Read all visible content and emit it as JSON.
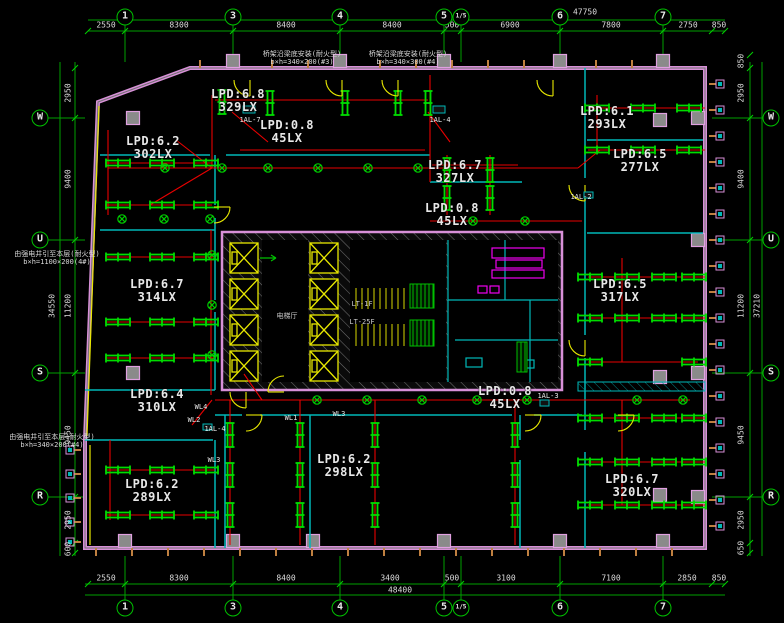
{
  "drawing_type": "electrical lighting floor plan",
  "grid": {
    "top_bubbles": [
      "1",
      "3",
      "4",
      "5",
      "1/5",
      "6",
      "7"
    ],
    "bottom_bubbles": [
      "1",
      "3",
      "4",
      "5",
      "1/5",
      "6",
      "7"
    ],
    "left_bubbles": [
      "W",
      "U",
      "S",
      "R"
    ],
    "right_bubbles": [
      "W",
      "U",
      "S",
      "R"
    ],
    "top_dims": [
      "2550",
      "8300",
      "8400",
      "8400",
      "500",
      "6900",
      "7800",
      "2750",
      "850"
    ],
    "top_overall": "47750",
    "bottom_dims": [
      "2550",
      "8300",
      "8400",
      "3400",
      "500",
      "3100",
      "7100",
      "2850",
      "850"
    ],
    "bottom_overall": "48400",
    "left_dims": [
      "2950",
      "9400",
      "11200",
      "9450",
      "2950",
      "600"
    ],
    "left_overall": "34550",
    "right_dims": [
      "850",
      "2950",
      "9400",
      "11200",
      "9450",
      "2950",
      "650"
    ],
    "right_overall": "37210"
  },
  "rooms": [
    {
      "lpd": "LPD:6.8",
      "lux": "329LX"
    },
    {
      "lpd": "LPD:0.8",
      "lux": "45LX"
    },
    {
      "lpd": "LPD:6.2",
      "lux": "302LX"
    },
    {
      "lpd": "LPD:6.7",
      "lux": "327LX"
    },
    {
      "lpd": "LPD:0.8",
      "lux": "45LX"
    },
    {
      "lpd": "LPD:6.1",
      "lux": "293LX"
    },
    {
      "lpd": "LPD:6.5",
      "lux": "277LX"
    },
    {
      "lpd": "LPD:6.5",
      "lux": "317LX"
    },
    {
      "lpd": "LPD:6.7",
      "lux": "314LX"
    },
    {
      "lpd": "LPD:6.4",
      "lux": "310LX"
    },
    {
      "lpd": "LPD:0.8",
      "lux": "45LX"
    },
    {
      "lpd": "LPD:6.2",
      "lux": "298LX"
    },
    {
      "lpd": "LPD:6.2",
      "lux": "289LX"
    },
    {
      "lpd": "LPD:6.7",
      "lux": "320LX"
    }
  ],
  "circuits": [
    "1AL-7",
    "1AL-4",
    "WL4",
    "WL2",
    "1AL-4",
    "WL3",
    "WL1",
    "WL3",
    "1AL-3",
    "1AL-2"
  ],
  "annotations": {
    "top1_l1": "桥架沿梁底安装(耐火型)",
    "top1_l2": "b×h=340×200(#3)",
    "top2_l1": "桥架沿梁底安装(耐火型)",
    "top2_l2": "b×h=340×300(#4)",
    "left1_l1": "由强电井引至本层(耐火型)",
    "left1_l2": "b×h=1100×200(4#)",
    "left2_l1": "由强电井引至本层(耐火型)",
    "left2_l2": "b×h=340×200(#4)"
  },
  "core": {
    "elevator_hall": "电梯厅",
    "stair_label_1": "LT-1F",
    "stair_label_2": "LT-25F"
  },
  "colors": {
    "grid_green": "#00c000",
    "wiring_red": "#e80000",
    "partition_cyan": "#00b8b8",
    "door_yellow": "#e8e800",
    "wall_pink": "#d890d8",
    "equipment_magenta": "#f000f0",
    "text_white": "#e8e8e8"
  }
}
